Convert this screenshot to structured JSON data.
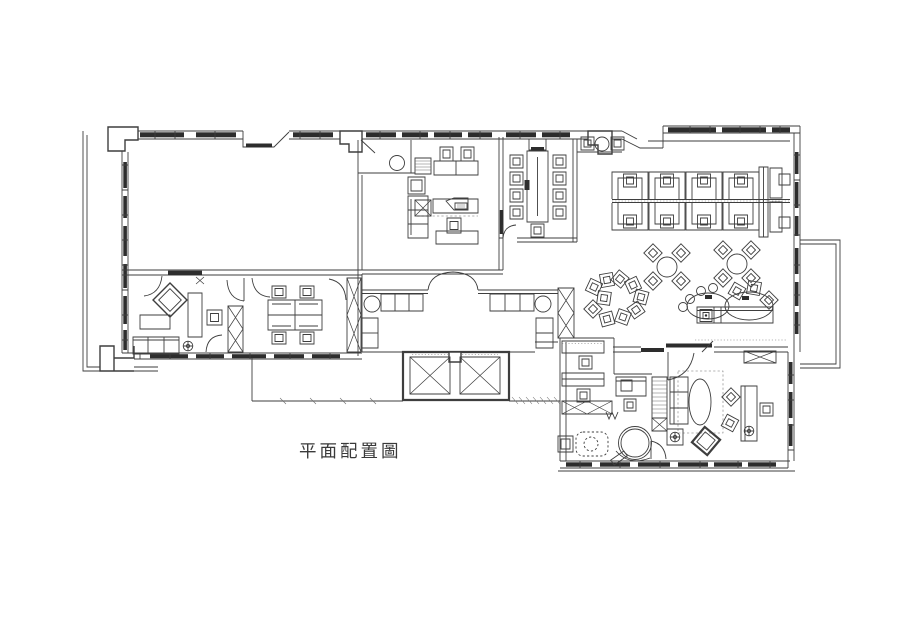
{
  "title": {
    "label": "平面配置圖"
  },
  "drawing": {
    "background": "#ffffff",
    "line_color": "#3e3e3e",
    "dark_fill": "#2d2d2d",
    "label_color": "#3a3a3a"
  }
}
